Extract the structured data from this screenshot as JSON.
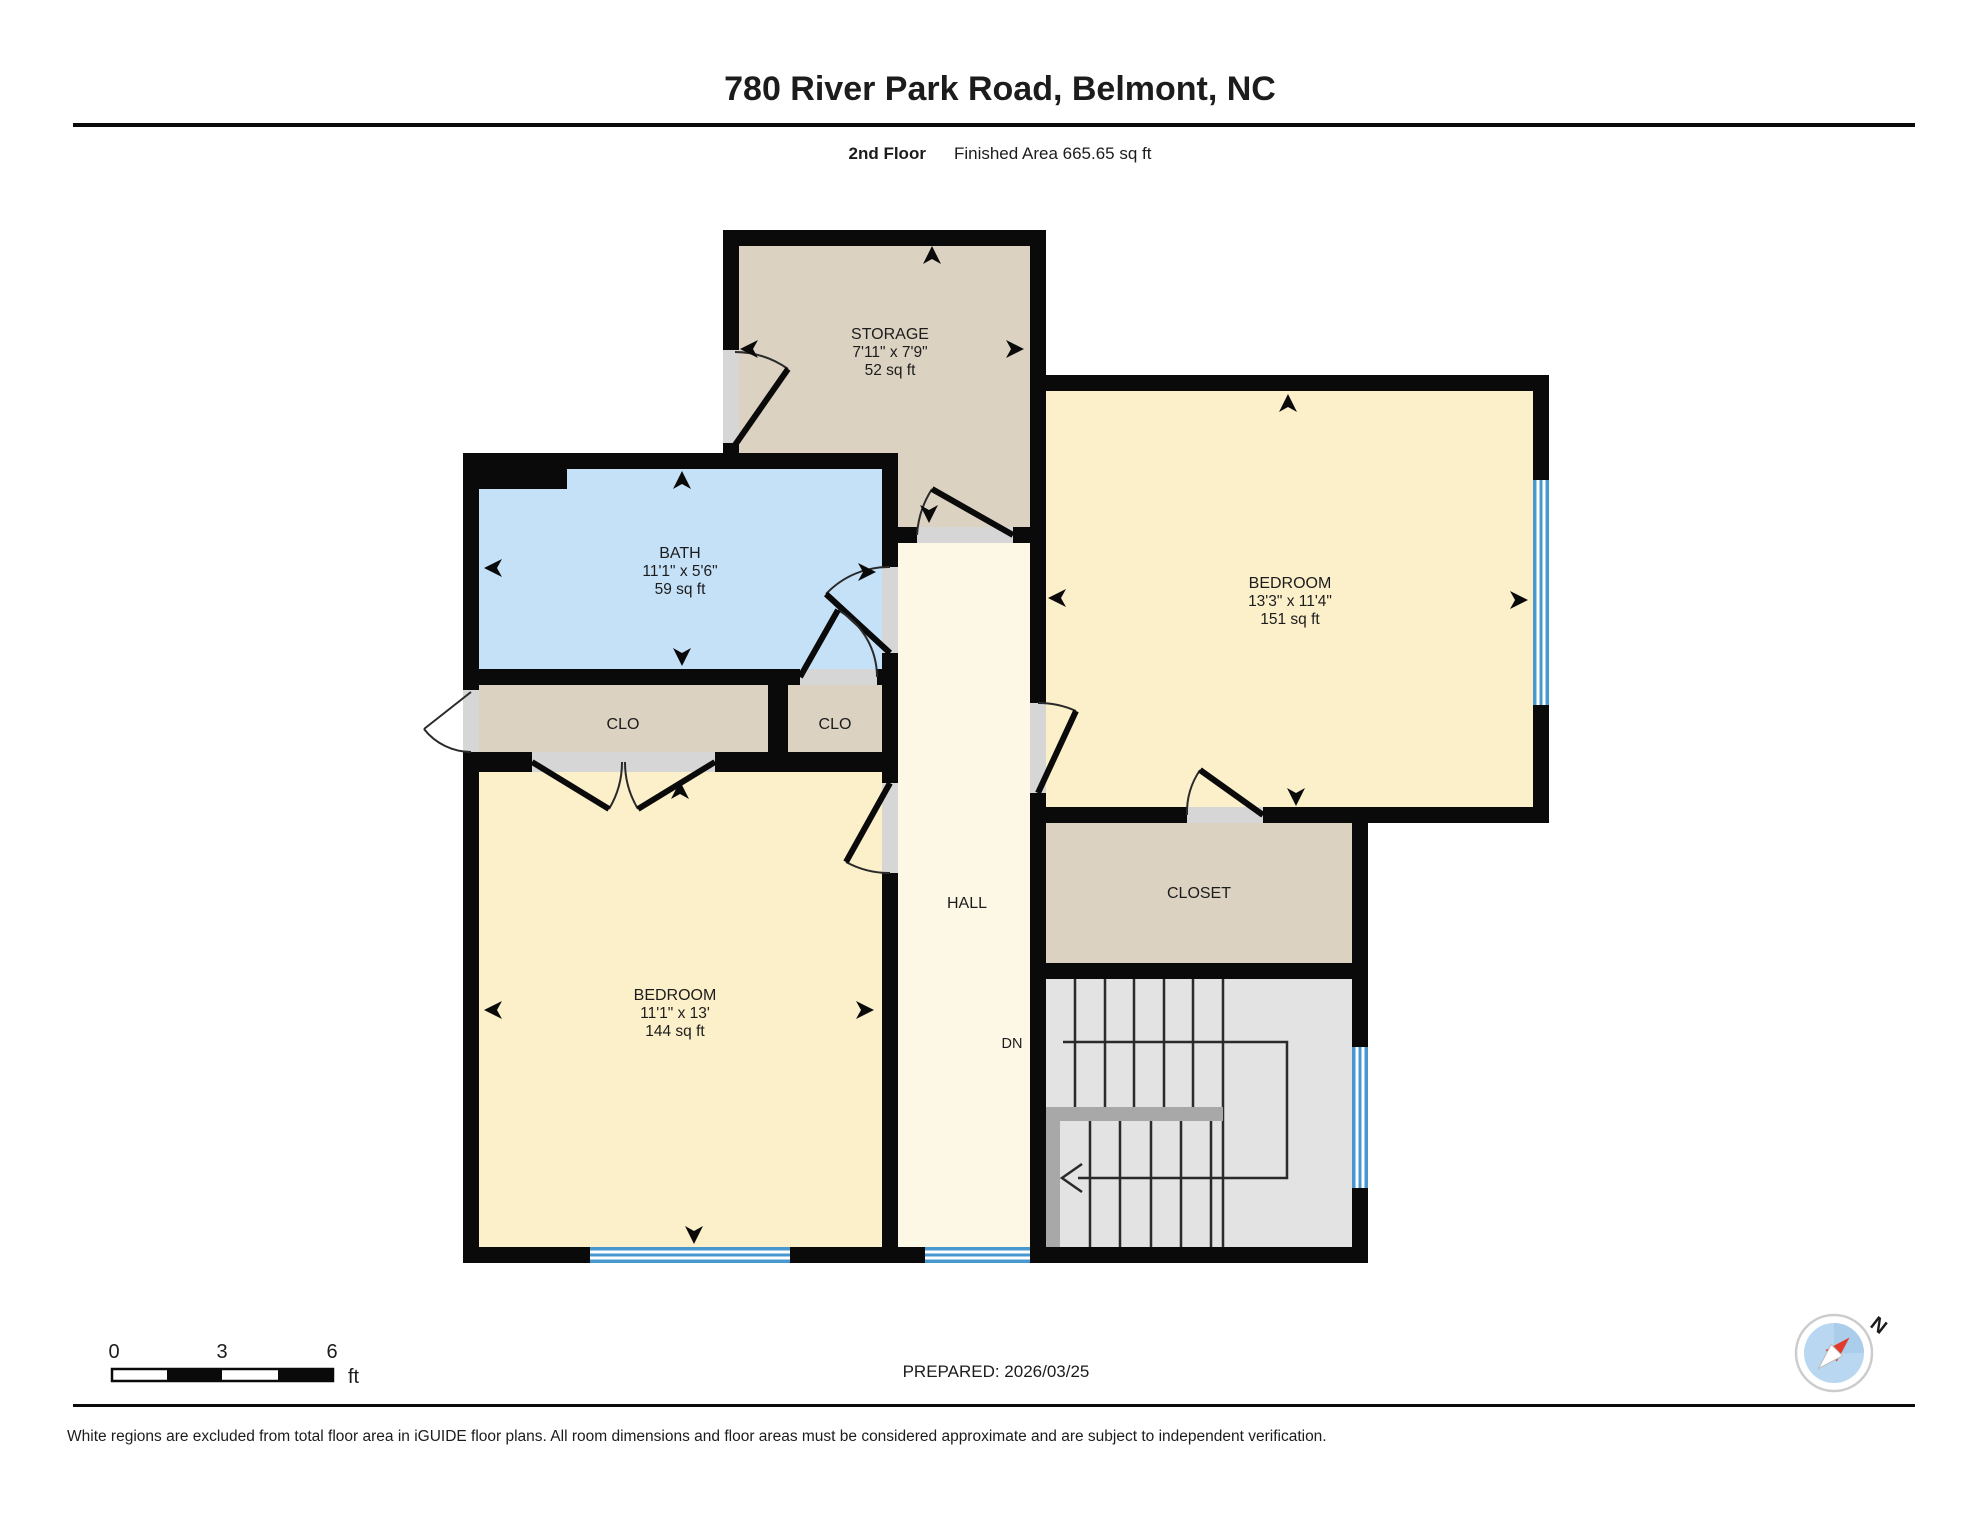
{
  "header": {
    "title": "780 River Park Road, Belmont, NC",
    "floor_label": "2nd Floor",
    "area_label": "Finished Area 665.65 sq ft"
  },
  "rooms": {
    "storage": {
      "name": "STORAGE",
      "dims": "7'11\" x 7'9\"",
      "area": "52 sq ft"
    },
    "bath": {
      "name": "BATH",
      "dims": "11'1\" x 5'6\"",
      "area": "59 sq ft"
    },
    "bedroom_right": {
      "name": "BEDROOM",
      "dims": "13'3\" x 11'4\"",
      "area": "151 sq ft"
    },
    "bedroom_left": {
      "name": "BEDROOM",
      "dims": "11'1\" x 13'",
      "area": "144 sq ft"
    },
    "closet_left": {
      "name": "CLO"
    },
    "closet_mid": {
      "name": "CLO"
    },
    "closet_right": {
      "name": "CLOSET"
    },
    "hall": {
      "name": "HALL"
    },
    "stairs": {
      "down_label": "DN"
    }
  },
  "scale_bar": {
    "tick_0": "0",
    "tick_3": "3",
    "tick_6": "6",
    "unit": "ft"
  },
  "footer": {
    "prepared": "PREPARED: 2026/03/25",
    "disclaimer": "White regions are excluded from total floor area in iGUIDE floor plans. All room dimensions and floor areas must be considered approximate and are subject to independent verification.",
    "compass_north": "N"
  },
  "icons": [
    "compass-icon",
    "direction-arrow-icon",
    "door-swing",
    "window"
  ],
  "colors": {
    "wall": "#0a0a0a",
    "bedroom_fill": "#fcf0cb",
    "bath_fill": "#c4e1f8",
    "closet_fill": "#dbd2c2",
    "hall_fill": "#fdf8e6",
    "stairs_fill": "#e3e3e3",
    "window_blue": "#4798cf",
    "door_gray": "#d6d6d6",
    "landing_gray": "#a8a8a8"
  }
}
